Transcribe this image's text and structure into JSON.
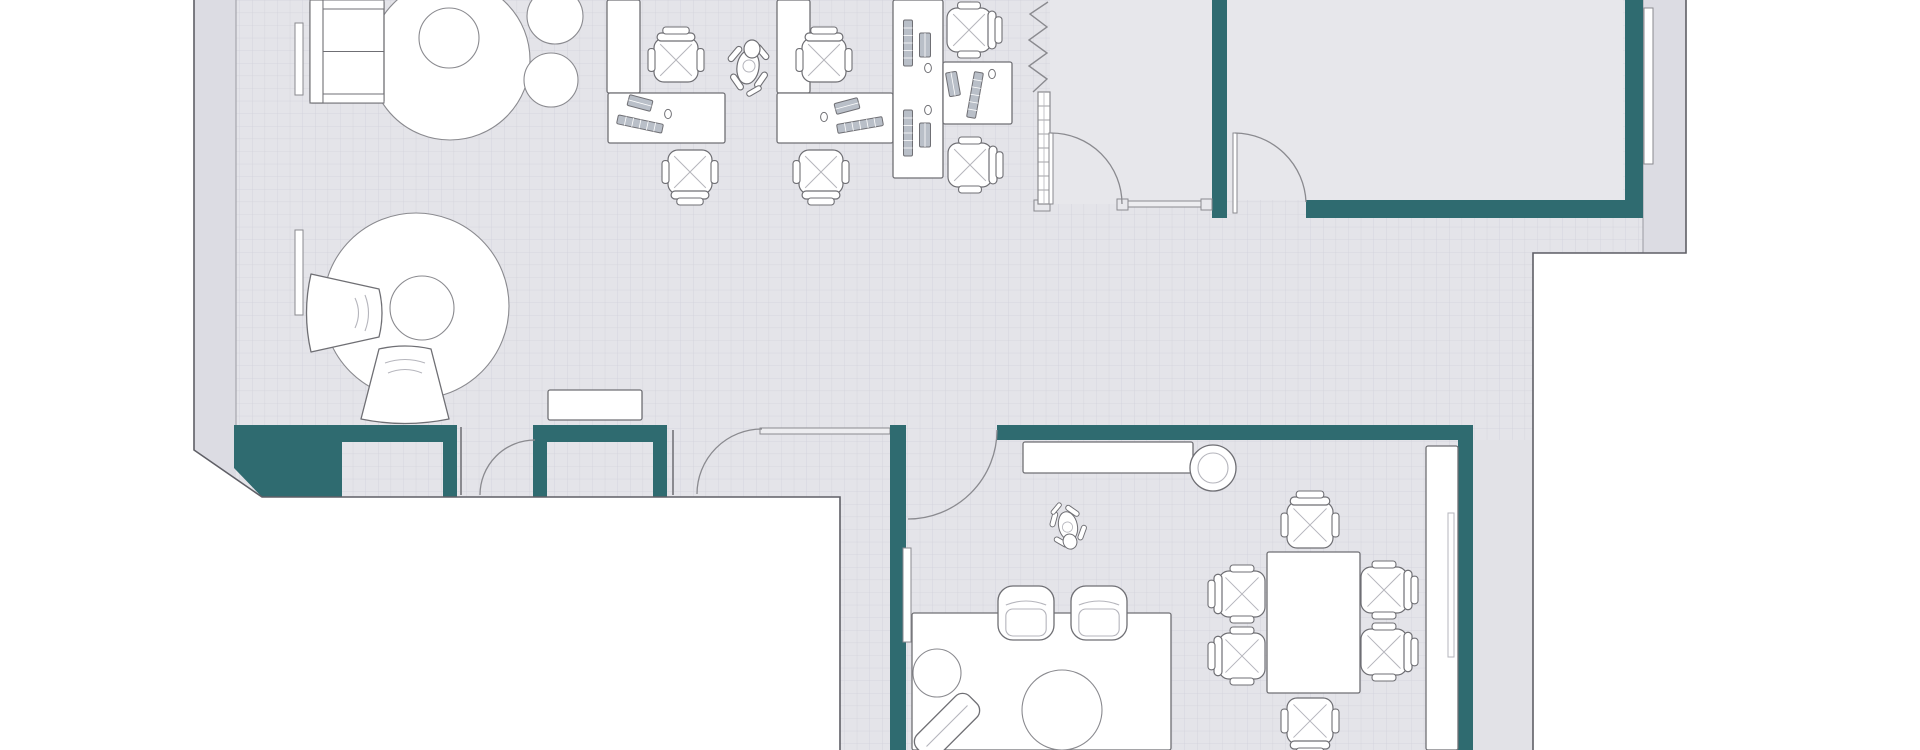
{
  "app": {
    "type": "floor-plan",
    "title": "office-floor-plan-top-view"
  },
  "palette": {
    "page": "#ffffff",
    "floor": "#e4e4e9",
    "gridLine": "#d2d2db",
    "roomPlain": "#e7e7eb",
    "bandPlain": "#e2e2e7",
    "band": "#dcdce3",
    "teal": "#2f6b70",
    "thinWall": "#8a8a8f",
    "boundary": "#5f5f66",
    "furnStroke": "#6f6f74",
    "furnFill": "#ffffff",
    "equipFill": "#b9bfc8",
    "innerEdge": "#9a9aa2",
    "faint": "#b5b5bc"
  },
  "canvas": {
    "w": 1920,
    "h": 750,
    "gridSize": 12.6
  },
  "floors": {
    "band": [
      [
        194,
        0,
        42,
        497
      ],
      [
        1643,
        0,
        43,
        253
      ]
    ],
    "grid": [
      [
        236,
        0,
        1407,
        253
      ],
      [
        236,
        253,
        1297,
        172
      ],
      [
        236,
        425,
        604,
        72
      ],
      [
        840,
        425,
        693,
        325
      ]
    ],
    "plain": [
      [
        1050,
        0,
        162,
        204
      ],
      [
        1227,
        0,
        396,
        200
      ]
    ],
    "bandPlain": [
      [
        1473,
        440,
        60,
        310
      ]
    ]
  },
  "whiteCover": [
    [
      194,
      450
    ],
    [
      262,
      497
    ],
    [
      194,
      497
    ]
  ],
  "boundaryPaths": [
    "M194,0 V450 L262,497 H840 V750",
    "M1686,0 V253 H1533 V750"
  ],
  "innerEdges": [
    "M236,0 V468",
    "M1643,0 V253"
  ],
  "tealRects": [
    {
      "name": "wall-south-left",
      "r": [
        234,
        425,
        223,
        17
      ]
    },
    {
      "name": "wall-south-leg",
      "r": [
        443,
        442,
        14,
        55
      ]
    },
    {
      "name": "wall-south-mid",
      "r": [
        533,
        425,
        134,
        17
      ]
    },
    {
      "name": "wall-south-leg",
      "r": [
        533,
        442,
        14,
        55
      ]
    },
    {
      "name": "wall-south-leg",
      "r": [
        653,
        442,
        14,
        55
      ]
    },
    {
      "name": "wall-center-vertical",
      "r": [
        890,
        425,
        16,
        325
      ]
    },
    {
      "name": "wall-meeting-north",
      "r": [
        997,
        425,
        473,
        15
      ]
    },
    {
      "name": "wall-meeting-east",
      "r": [
        1458,
        425,
        15,
        325
      ]
    },
    {
      "name": "wall-room-divider",
      "r": [
        1212,
        0,
        15,
        218
      ]
    },
    {
      "name": "wall-room-b-south",
      "r": [
        1306,
        200,
        337,
        18
      ]
    },
    {
      "name": "wall-room-b-east",
      "r": [
        1625,
        0,
        18,
        218
      ]
    }
  ],
  "tealPolys": [
    {
      "name": "wall-south-block",
      "pts": [
        [
          234,
          442
        ],
        [
          342,
          442
        ],
        [
          342,
          497
        ],
        [
          262,
          497
        ],
        [
          234,
          468
        ]
      ]
    }
  ],
  "thinWalls": [
    {
      "name": "wall-segment",
      "r": [
        760,
        428,
        130,
        6
      ]
    },
    {
      "name": "glass-wall",
      "r": [
        1127,
        201,
        75,
        6
      ]
    }
  ],
  "edgeLines": [
    "M461,427 V495",
    "M673,430 V495"
  ],
  "posts": [
    [
      1117,
      199,
      11,
      11
    ],
    [
      1201,
      199,
      11,
      11
    ],
    [
      1034,
      200,
      16,
      11
    ]
  ],
  "slidingDoor": [
    903,
    548,
    8,
    94
  ],
  "radiators": [
    [
      295,
      23,
      8,
      72
    ],
    [
      295,
      230,
      8,
      85
    ],
    [
      1644,
      8,
      9,
      156
    ]
  ],
  "accordion": {
    "zigzag": "M1048,2 L1030,14 L1047,27 L1029,40 L1047,53 L1029,66 L1047,79 L1033,92",
    "stack": [
      1038,
      92,
      12,
      112
    ],
    "rungStep": 14
  },
  "doors": [
    {
      "name": "door-south-entrance",
      "arc": "M480,495 A55,55 0 0 1 535,440"
    },
    {
      "name": "door-corridor",
      "arc": "M697,494 A65,65 0 0 1 762,429"
    },
    {
      "name": "door-meeting-room",
      "arc": "M908,519 A89,89 0 0 0 997,430"
    },
    {
      "name": "door-room-a",
      "arc": "M1051,133 A71,71 0 0 1 1122,204",
      "leaf": [
        1049,
        133,
        4,
        71
      ]
    },
    {
      "name": "door-room-b",
      "arc": "M1235,133 A72,72 0 0 1 1306,202",
      "leaf": [
        1233,
        133,
        4,
        80
      ]
    }
  ],
  "furniture": [
    {
      "t": "circle",
      "name": "round-rug",
      "cx": 450,
      "cy": 60,
      "r": 80
    },
    {
      "t": "sofa",
      "name": "sofa",
      "x": 310,
      "y": 0,
      "w": 74,
      "h": 103
    },
    {
      "t": "circle",
      "name": "round-table",
      "cx": 449,
      "cy": 38,
      "r": 30
    },
    {
      "t": "circle",
      "name": "ottoman",
      "cx": 555,
      "cy": 16,
      "r": 28
    },
    {
      "t": "circle",
      "name": "ottoman",
      "cx": 551,
      "cy": 80,
      "r": 27
    },
    {
      "t": "circle",
      "name": "round-rug",
      "cx": 416,
      "cy": 306,
      "r": 93
    },
    {
      "t": "circle",
      "name": "round-table",
      "cx": 422,
      "cy": 308,
      "r": 32
    },
    {
      "t": "petal",
      "name": "lounge-armchair",
      "cx": 345,
      "cy": 313,
      "rot": 0,
      "back": 78,
      "front": 48,
      "depth": 68
    },
    {
      "t": "petal",
      "name": "lounge-armchair",
      "cx": 405,
      "cy": 384,
      "rot": -90,
      "back": 88,
      "front": 52,
      "depth": 70
    },
    {
      "t": "rect",
      "name": "console-table",
      "x": 548,
      "y": 390,
      "w": 94,
      "h": 30
    },
    {
      "t": "rect",
      "name": "desk-return",
      "x": 607,
      "y": 0,
      "w": 33,
      "h": 93
    },
    {
      "t": "rect",
      "name": "desk",
      "x": 608,
      "y": 93,
      "w": 117,
      "h": 50
    },
    {
      "t": "rect",
      "name": "desk-return",
      "x": 777,
      "y": 0,
      "w": 33,
      "h": 93
    },
    {
      "t": "rect",
      "name": "desk",
      "x": 777,
      "y": 93,
      "w": 116,
      "h": 50
    },
    {
      "t": "rect",
      "name": "desk",
      "x": 893,
      "y": 0,
      "w": 50,
      "h": 178
    },
    {
      "t": "rect",
      "name": "desk",
      "x": 943,
      "y": 62,
      "w": 69,
      "h": 62
    },
    {
      "t": "rect",
      "name": "kitchen-counter",
      "x": 1023,
      "y": 442,
      "w": 170,
      "h": 31
    },
    {
      "t": "stool",
      "name": "stool",
      "cx": 1213,
      "cy": 468,
      "r": 23,
      "r2": 15
    },
    {
      "t": "rect",
      "name": "wall-cabinet",
      "x": 1426,
      "y": 446,
      "w": 32,
      "h": 304
    },
    {
      "t": "faintRect",
      "name": "cabinet-detail",
      "x": 1448,
      "y": 513,
      "w": 6,
      "h": 144
    },
    {
      "t": "rect",
      "name": "lounge-rug",
      "x": 912,
      "y": 613,
      "w": 259,
      "h": 137
    },
    {
      "t": "circle",
      "name": "side-table",
      "cx": 937,
      "cy": 673,
      "r": 24
    },
    {
      "t": "circle",
      "name": "round-table",
      "cx": 1062,
      "cy": 710,
      "r": 40
    },
    {
      "t": "box",
      "name": "armchair",
      "cx": 1026,
      "cy": 613,
      "w": 56,
      "h": 54,
      "rot": 0
    },
    {
      "t": "box",
      "name": "armchair",
      "cx": 1099,
      "cy": 613,
      "w": 56,
      "h": 54,
      "rot": 0
    },
    {
      "t": "chaise",
      "name": "chaise",
      "cx": 947,
      "cy": 726,
      "rot": -45,
      "w": 74,
      "h": 30
    },
    {
      "t": "rect",
      "name": "meeting-table",
      "x": 1267,
      "y": 552,
      "w": 93,
      "h": 141
    }
  ],
  "equipment": [
    {
      "t": "keyboard",
      "cx": 640,
      "cy": 103,
      "rot": 15
    },
    {
      "t": "monitor",
      "cx": 640,
      "cy": 124,
      "rot": 12
    },
    {
      "t": "mouse",
      "cx": 668,
      "cy": 114
    },
    {
      "t": "keyboard",
      "cx": 847,
      "cy": 106,
      "rot": -15
    },
    {
      "t": "monitor",
      "cx": 860,
      "cy": 125,
      "rot": -10
    },
    {
      "t": "mouse",
      "cx": 824,
      "cy": 117
    },
    {
      "t": "monitor",
      "cx": 908,
      "cy": 43,
      "rot": 90
    },
    {
      "t": "keyboard",
      "cx": 925,
      "cy": 45,
      "rot": 90
    },
    {
      "t": "mouse",
      "cx": 928,
      "cy": 68
    },
    {
      "t": "monitor",
      "cx": 908,
      "cy": 133,
      "rot": 90
    },
    {
      "t": "keyboard",
      "cx": 925,
      "cy": 135,
      "rot": 90
    },
    {
      "t": "mouse",
      "cx": 928,
      "cy": 110
    },
    {
      "t": "monitor",
      "cx": 975,
      "cy": 95,
      "rot": 100
    },
    {
      "t": "keyboard",
      "cx": 953,
      "cy": 84,
      "rot": 80
    },
    {
      "t": "mouse",
      "cx": 992,
      "cy": 74
    }
  ],
  "chairs": [
    {
      "name": "task-chair",
      "cx": 676,
      "cy": 60,
      "rot": 180
    },
    {
      "name": "task-chair",
      "cx": 824,
      "cy": 60,
      "rot": 180
    },
    {
      "name": "task-chair",
      "cx": 690,
      "cy": 172,
      "rot": 0
    },
    {
      "name": "task-chair",
      "cx": 821,
      "cy": 172,
      "rot": 0
    },
    {
      "name": "task-chair",
      "cx": 969,
      "cy": 30,
      "rot": 270
    },
    {
      "name": "task-chair",
      "cx": 970,
      "cy": 165,
      "rot": 270
    },
    {
      "name": "meeting-chair",
      "cx": 1310,
      "cy": 525,
      "rot": 180
    },
    {
      "name": "meeting-chair",
      "cx": 1310,
      "cy": 721,
      "rot": 0
    },
    {
      "name": "meeting-chair",
      "cx": 1242,
      "cy": 594,
      "rot": 90
    },
    {
      "name": "meeting-chair",
      "cx": 1242,
      "cy": 656,
      "rot": 90
    },
    {
      "name": "meeting-chair",
      "cx": 1384,
      "cy": 590,
      "rot": 270
    },
    {
      "name": "meeting-chair",
      "cx": 1384,
      "cy": 652,
      "rot": 270
    }
  ],
  "animals": [
    {
      "kind": "dog",
      "cx": 748,
      "cy": 67,
      "rot": 0
    },
    {
      "kind": "cat",
      "cx": 1068,
      "cy": 526,
      "rot": 160
    }
  ]
}
